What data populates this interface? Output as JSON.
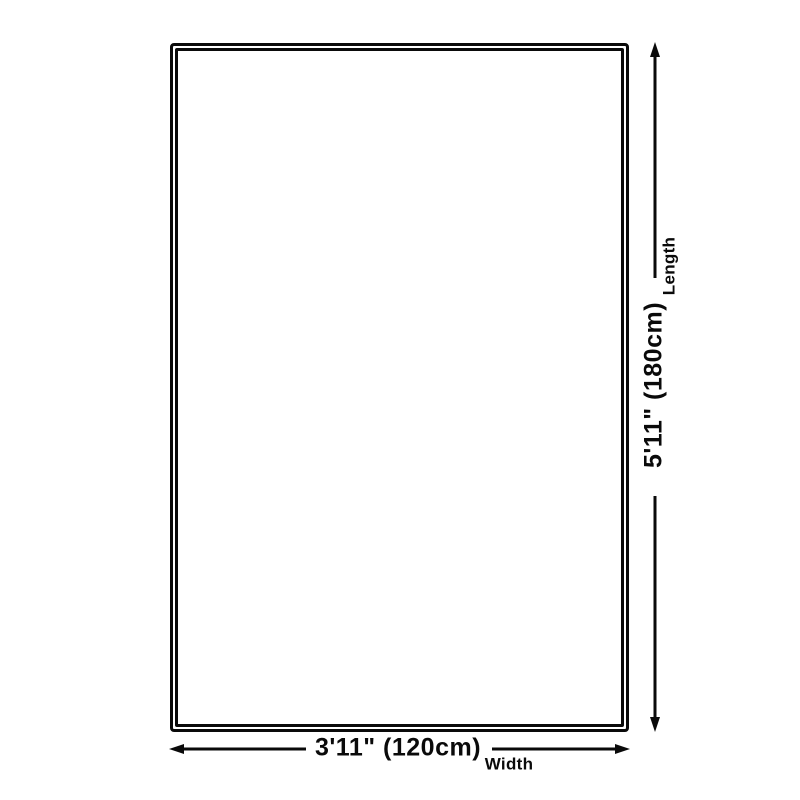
{
  "diagram": {
    "kind": "product-dimension-diagram",
    "background_color": "#ffffff",
    "line_color": "#0a0a0a",
    "shape": "rectangle-double-border",
    "length": {
      "value": "5'11\" (180cm)",
      "axis_label": "Length",
      "orientation": "vertical"
    },
    "width": {
      "value": "3'11\" (120cm)",
      "axis_label": "Width",
      "orientation": "horizontal"
    }
  }
}
